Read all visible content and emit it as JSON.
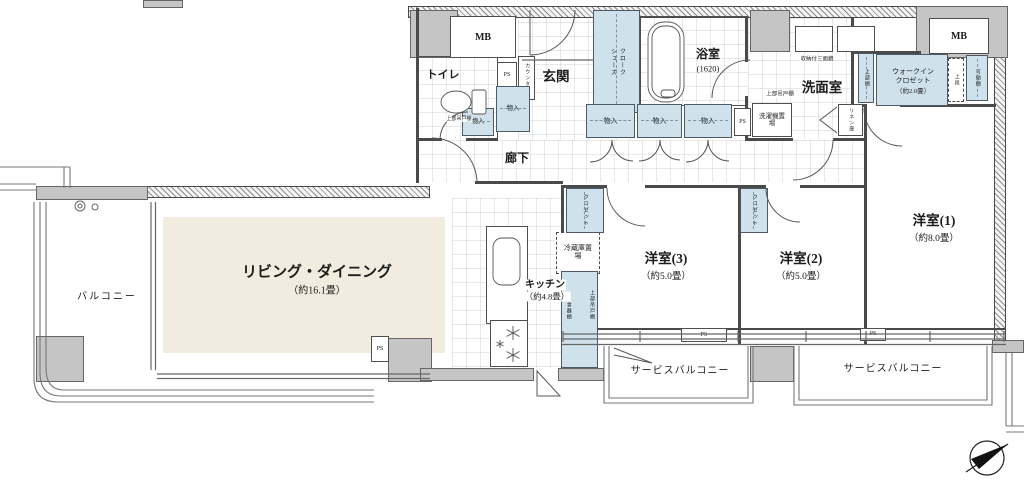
{
  "colors": {
    "storage": "#cfe1eb",
    "floor_wood": "#f1ecdf",
    "concrete": "#c5c5c5",
    "wall": "#4a4a4a"
  },
  "rooms": {
    "living": {
      "name": "リビング・ダイニング",
      "size": "（約16.1畳）"
    },
    "kitchen": {
      "name": "キッチン",
      "size": "（約4.8畳）"
    },
    "bedroom1": {
      "name": "洋室(1)",
      "size": "（約8.0畳）"
    },
    "bedroom2": {
      "name": "洋室(2)",
      "size": "（約5.0畳）"
    },
    "bedroom3": {
      "name": "洋室(3)",
      "size": "（約5.0畳）"
    },
    "bathroom": {
      "name": "浴室",
      "size": "(1620)"
    },
    "washroom": {
      "name": "洗面室"
    },
    "toilet": {
      "name": "トイレ"
    },
    "entrance": {
      "name": "玄関"
    },
    "hallway": {
      "name": "廊下"
    },
    "balcony": {
      "name": "バルコニー"
    },
    "service_balcony": {
      "name": "サービスバルコニー"
    },
    "wic": {
      "name_line1": "ウォークイン",
      "name_line2": "クロゼット",
      "size": "（約2.0畳）"
    }
  },
  "fixtures": {
    "meter_box": "MB",
    "pipe_space": "PS",
    "storage": "物入",
    "shoe_closet_line1": "シューズ",
    "shoe_closet_line2": "クローク",
    "closet": "クロゼット",
    "refrigerator": "冷蔵庫置場",
    "washer": "洗濯機置場",
    "mirror": "収納付三面鏡",
    "upper_cabinet": "上部吊戸棚",
    "upper_shelf": "上部棚",
    "movable_shelf": "可動棚",
    "upper_stage": "上段",
    "linen": "リネン庫",
    "counter": "カウンター",
    "dish_shelf": "食器棚"
  }
}
